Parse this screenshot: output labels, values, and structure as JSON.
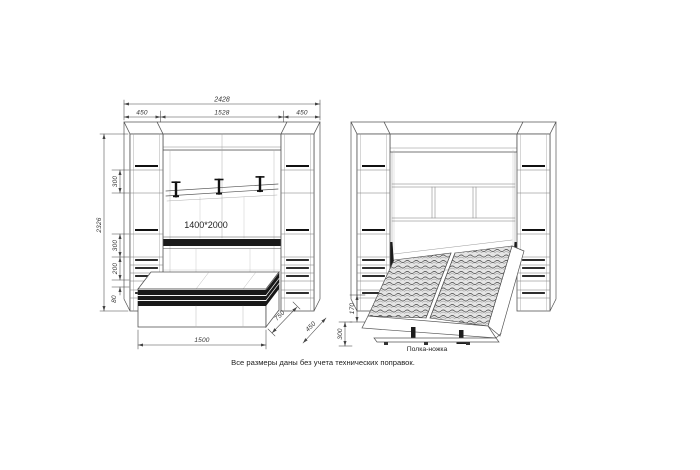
{
  "note": "Все размеры даны без учета технических поправок.",
  "closed_view": {
    "dims": {
      "total_width": "2428",
      "left_section": "450",
      "center_section": "1528",
      "right_section": "450",
      "total_height": "2326",
      "niche_top": "300",
      "niche_mid": "300",
      "drawer_block": "200",
      "plinth": "80",
      "bench_length": "1500",
      "bench_depth": "750",
      "cabinet_depth": "450",
      "bed_size": "1400*2000"
    }
  },
  "open_view": {
    "dims": {
      "frame_height": "170",
      "floor_clearance": "300"
    },
    "labels": {
      "shelf_leg": "Полка-ножка"
    }
  }
}
